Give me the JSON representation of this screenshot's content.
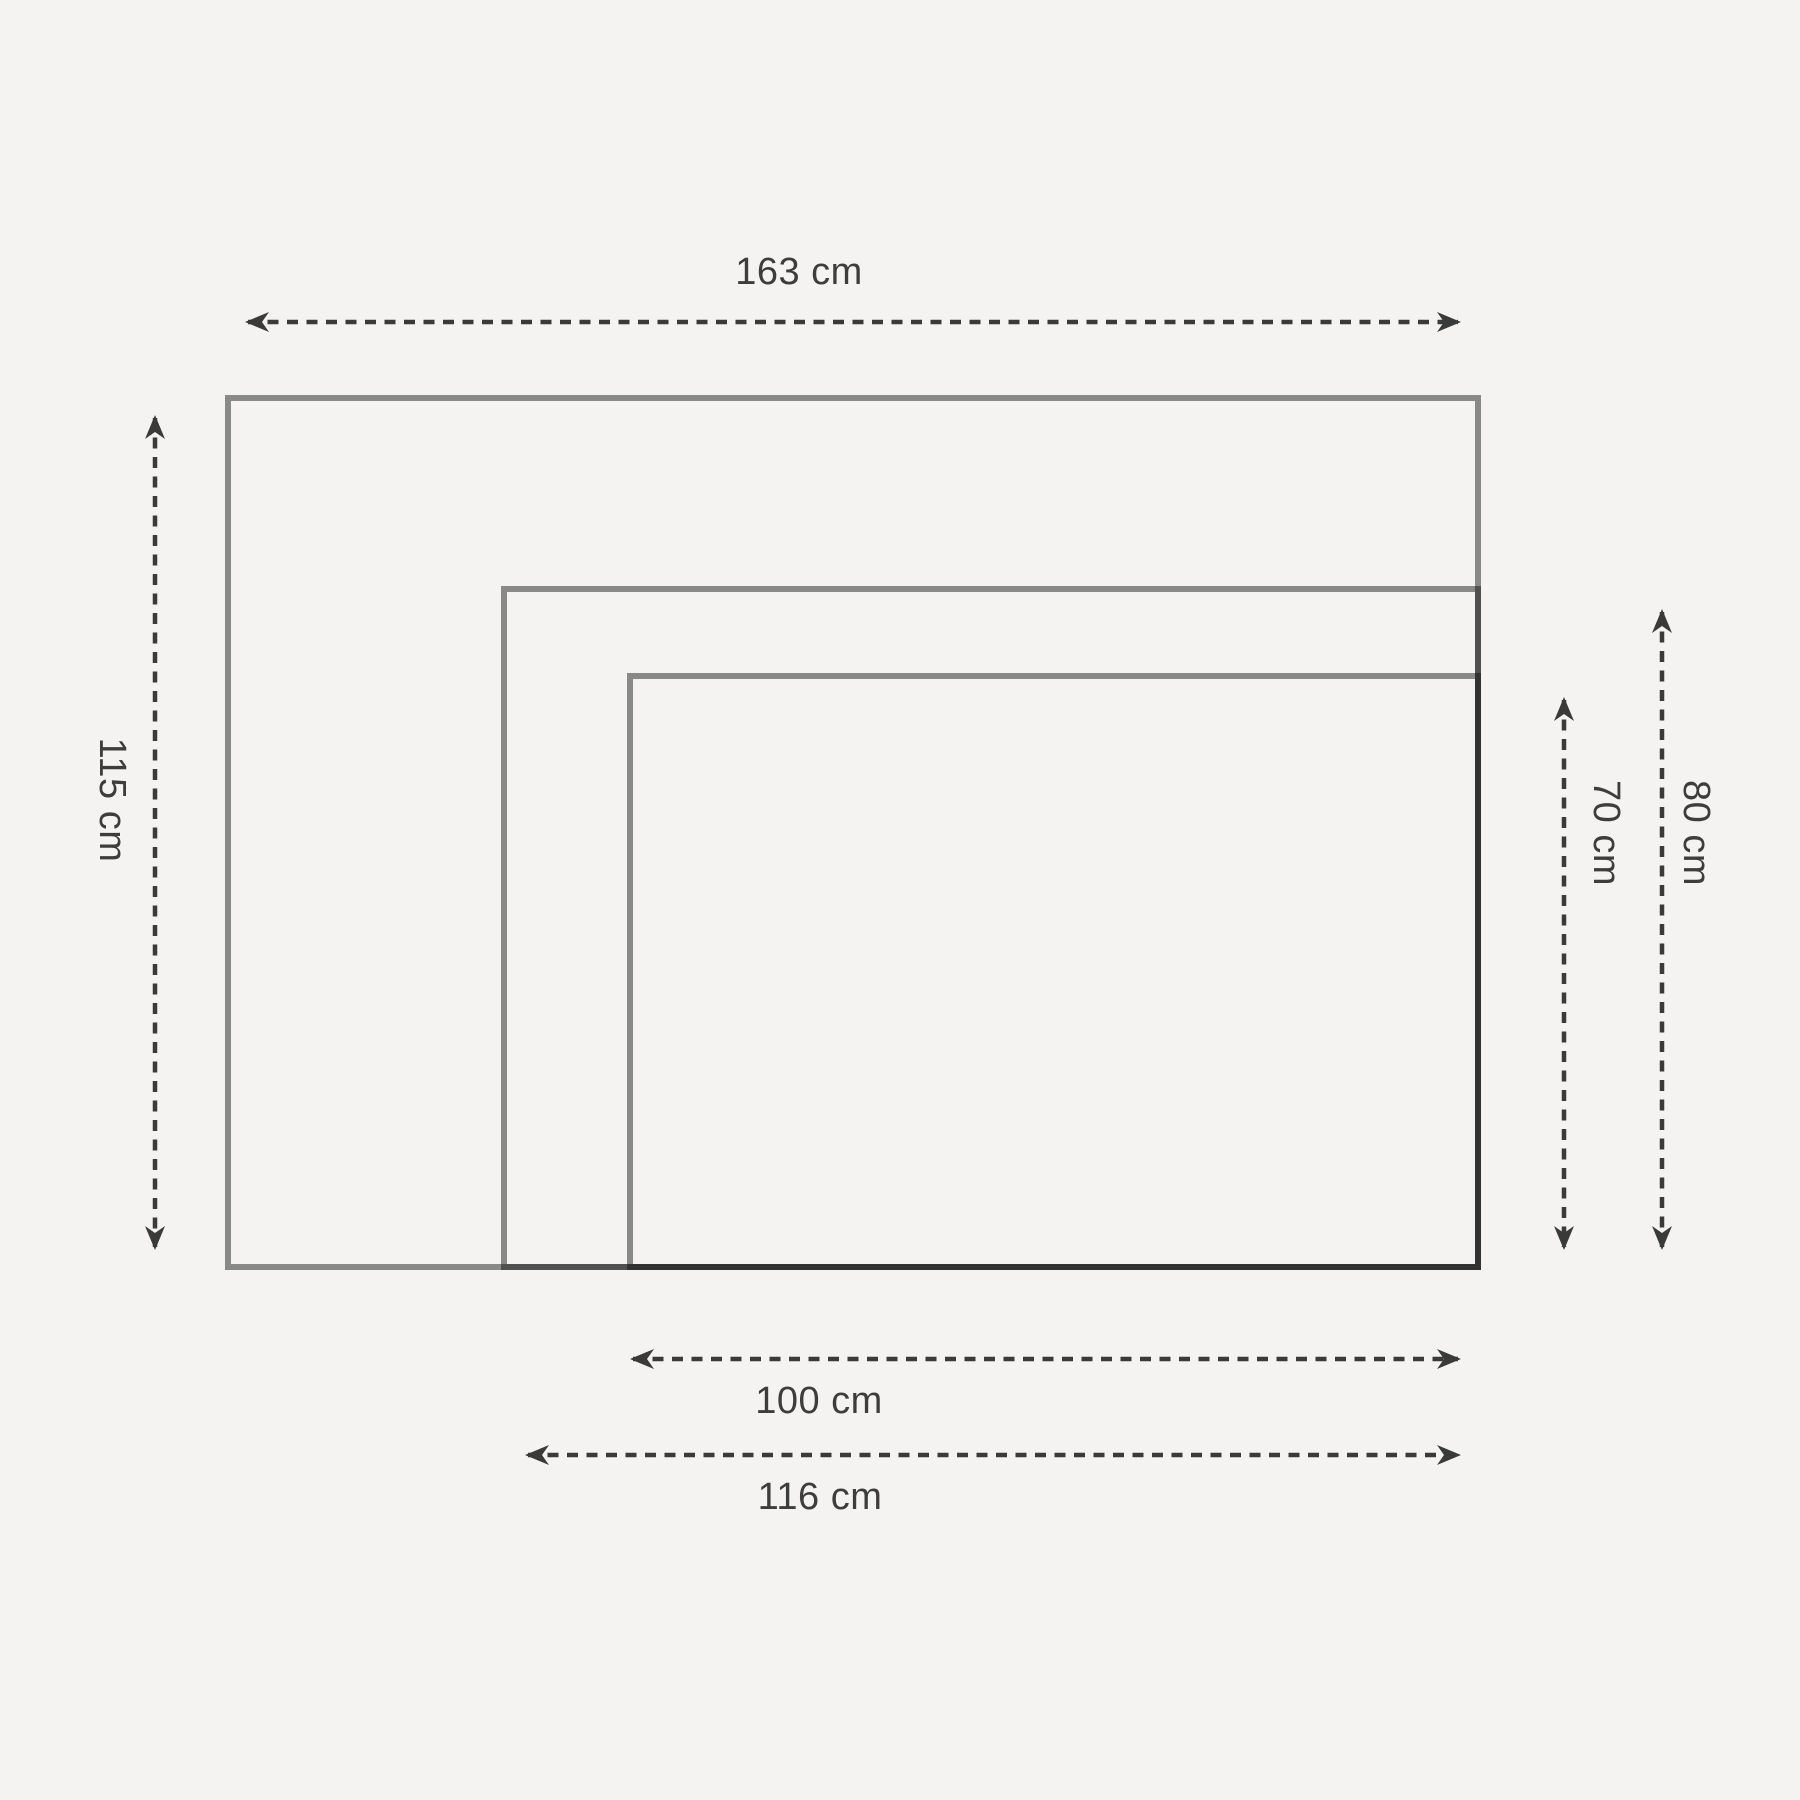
{
  "diagram": {
    "description": "nested-rectangles size comparison diagram",
    "colors": {
      "background": "#f4f3f1",
      "rect_stroke": "rgba(17,17,17,0.47)",
      "arrow": "#3a3a3a",
      "text": "#3d3d3d"
    },
    "labels": {
      "top_width": "163 cm",
      "left_height": "115 cm",
      "inner_height": "70 cm",
      "middle_height": "80 cm",
      "inner_width": "100 cm",
      "middle_width": "116 cm"
    }
  }
}
